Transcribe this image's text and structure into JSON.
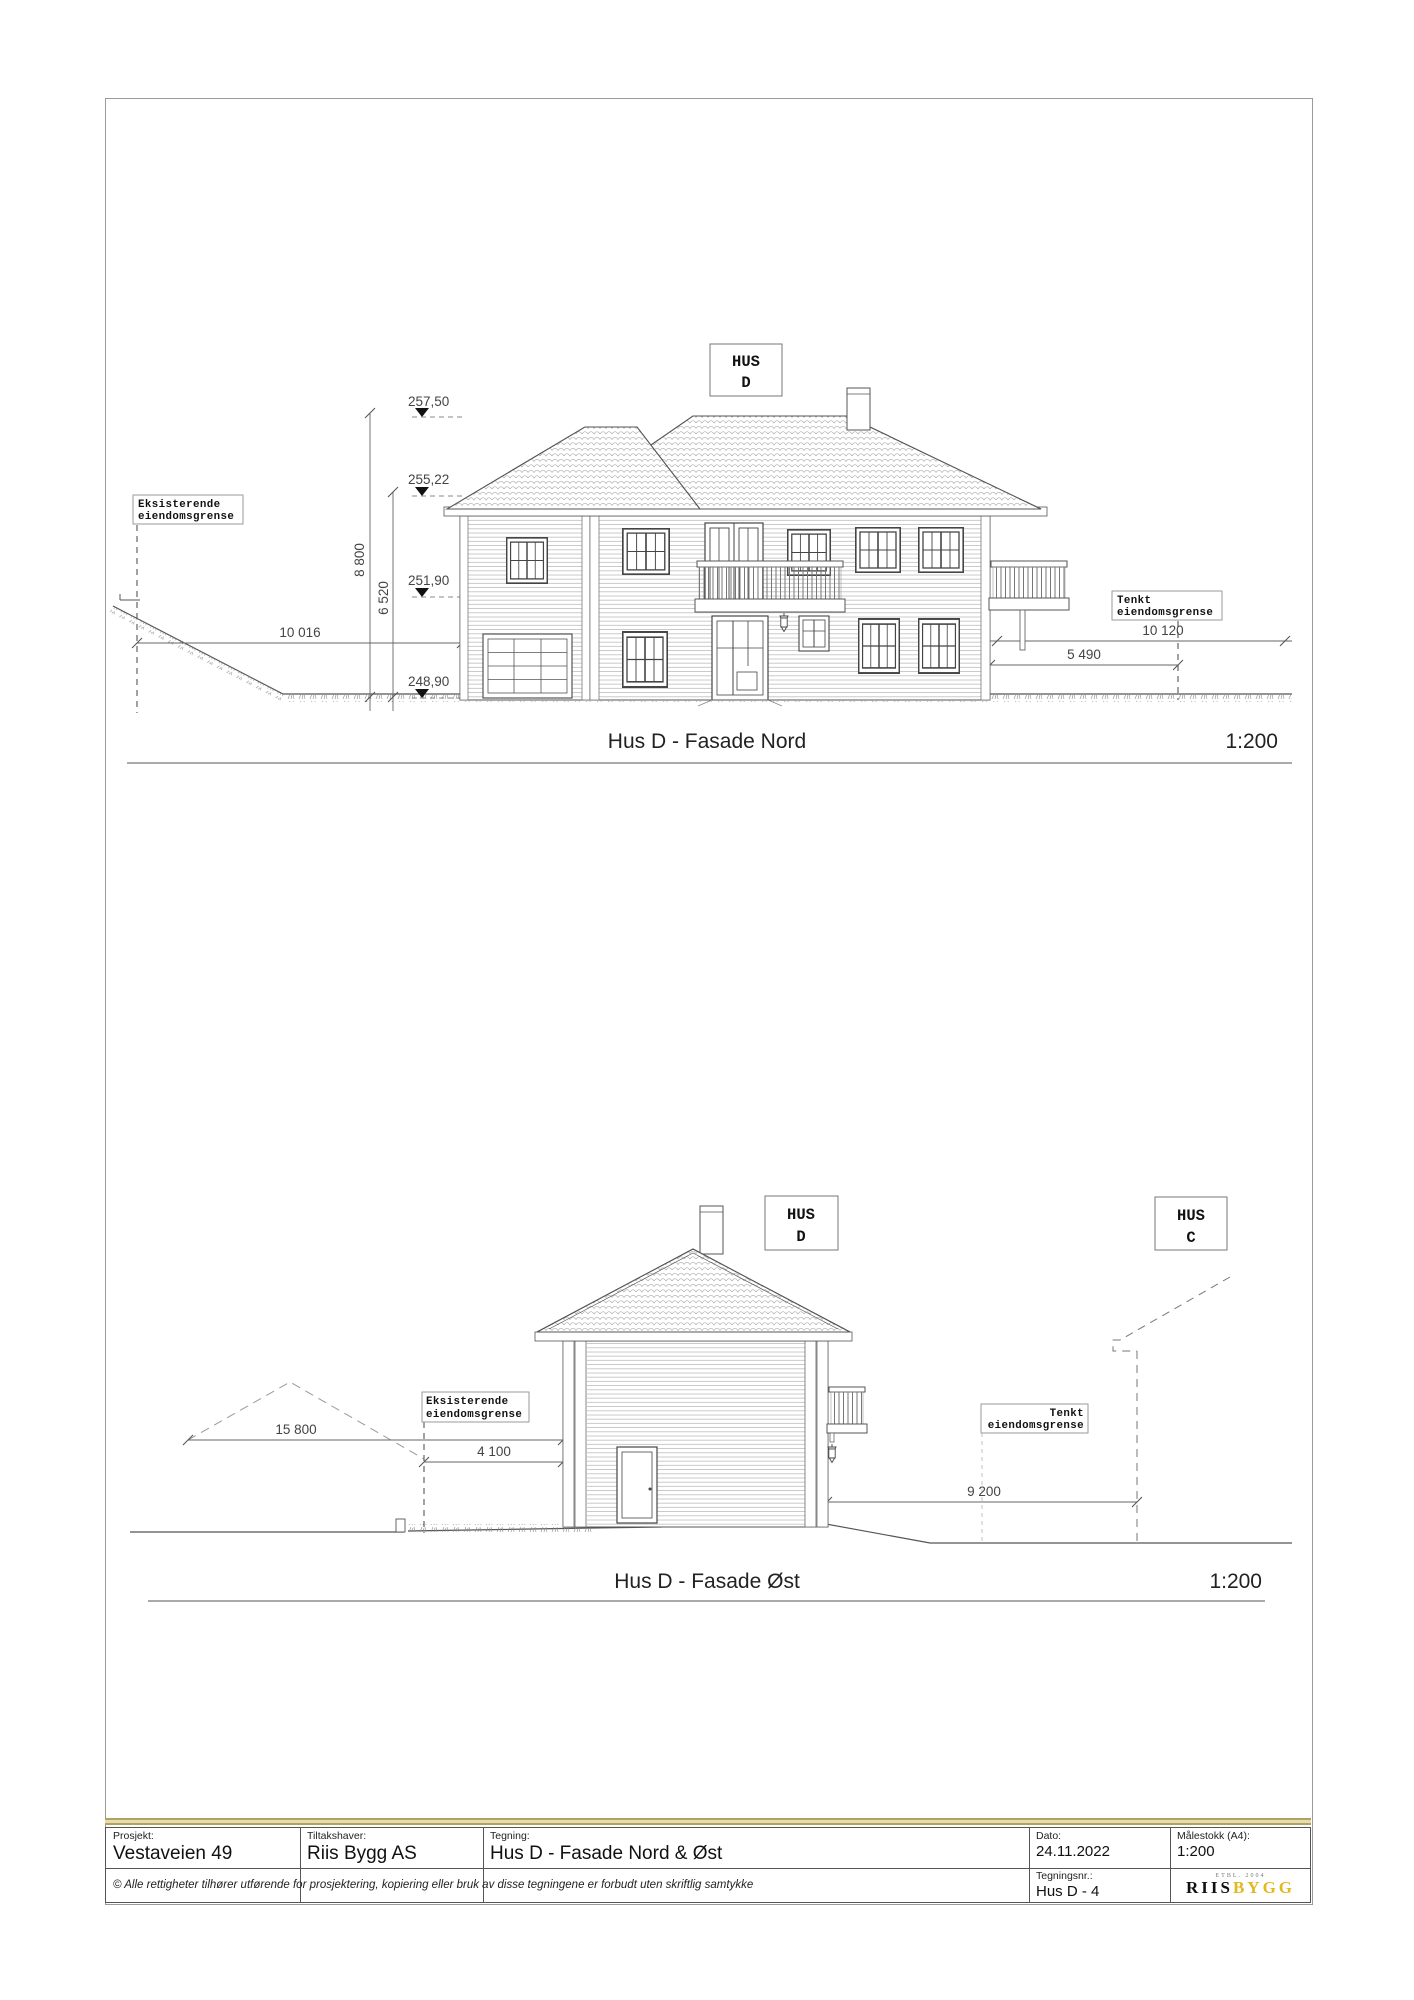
{
  "nord": {
    "title": "Hus D - Fasade Nord",
    "scale": "1:200",
    "hus": [
      "HUS",
      "D"
    ],
    "levels": [
      "257,50",
      "255,22",
      "251,90",
      "248,90"
    ],
    "dim_height_total": "8 800",
    "dim_height_eave": "6 520",
    "dim_left": "10 016",
    "dim_right_far": "10 120",
    "dim_right_near": "5 490",
    "label_existing": [
      "Eksisterende",
      "eiendomsgrense"
    ],
    "label_planned": [
      "Tenkt",
      "eiendomsgrense"
    ]
  },
  "ost": {
    "title": "Hus D - Fasade Øst",
    "scale": "1:200",
    "hus_d": [
      "HUS",
      "D"
    ],
    "hus_c": [
      "HUS",
      "C"
    ],
    "dim_left": "15 800",
    "dim_mid": "4 100",
    "dim_right": "9 200",
    "label_existing": [
      "Eksisterende",
      "eiendomsgrense"
    ],
    "label_planned": [
      "Tenkt",
      "eiendomsgrense"
    ]
  },
  "titleblock": {
    "project_label": "Prosjekt:",
    "project": "Vestaveien 49",
    "client_label": "Tiltakshaver:",
    "client": "Riis Bygg AS",
    "drawing_label": "Tegning:",
    "drawing": "Hus D - Fasade Nord & Øst",
    "date_label": "Dato:",
    "date": "24.11.2022",
    "scale_label": "Målestokk (A4):",
    "scale": "1:200",
    "number_label": "Tegningsnr.:",
    "number": "Hus D - 4",
    "copyright": "© Alle rettigheter tilhører utførende for prosjektering, kopiering eller bruk av disse tegningene er forbudt uten skriftlig samtykke",
    "logo_tagline": "ETBL. 2004",
    "logo_part1": "RIIS",
    "logo_part2": "BYGG",
    "logo_gold": "#e3b71e"
  }
}
